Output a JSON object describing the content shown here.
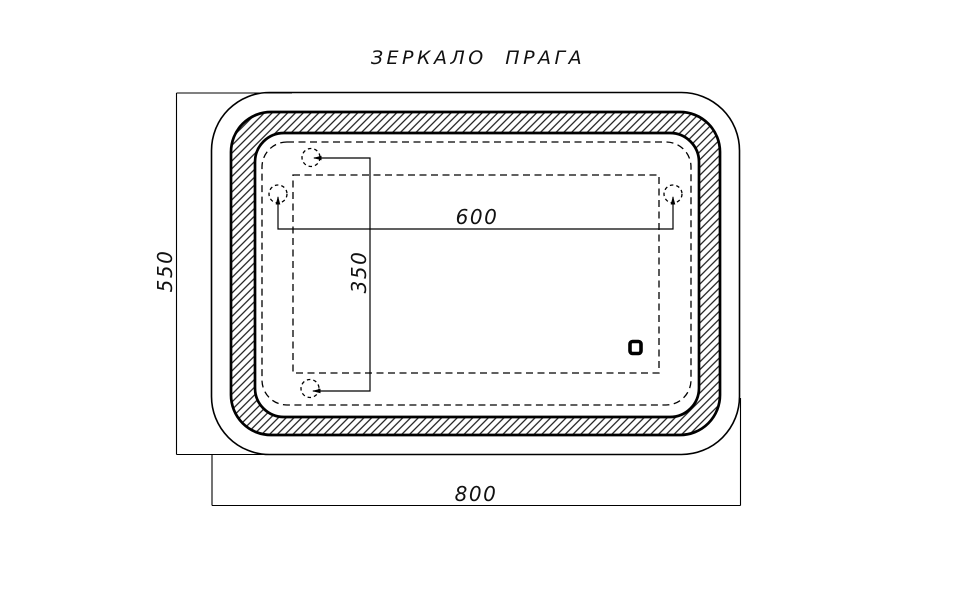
{
  "title": "ЗЕРКАЛО ПРАГА",
  "dimensions": {
    "overall_width_label": "800",
    "overall_height_label": "550",
    "hook_span_horizontal_label": "600",
    "hook_span_vertical_label": "350"
  },
  "colors": {
    "line": "#000000",
    "background": "#ffffff"
  },
  "icons": {
    "touch_switch": "touch-switch-icon",
    "mounting_hook": "mounting-hook-icon"
  }
}
